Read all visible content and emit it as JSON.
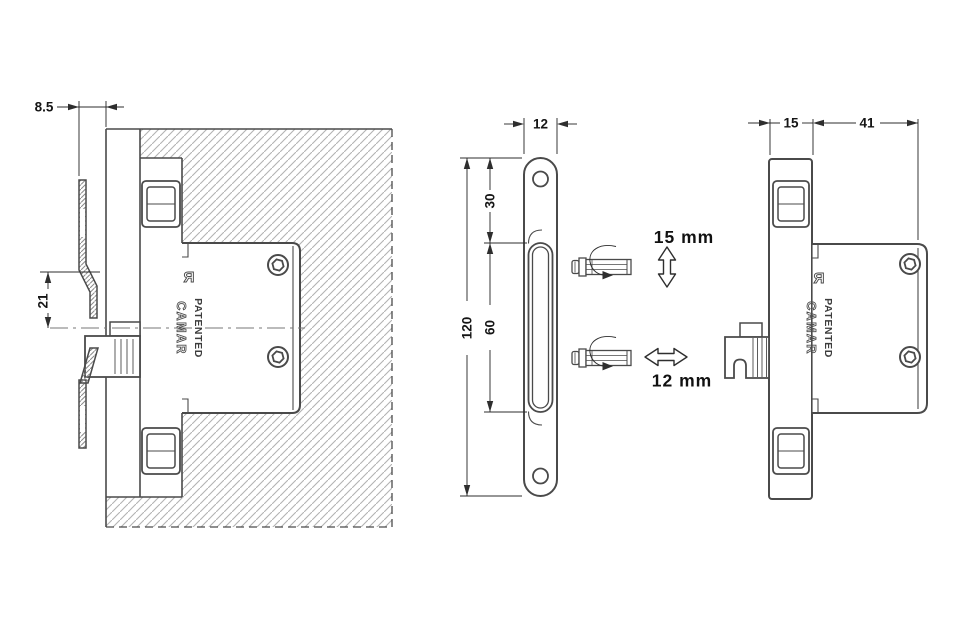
{
  "brand": {
    "name": "CAMAR",
    "patented": "PATENTED",
    "registered_mark": "R"
  },
  "views": {
    "section": {
      "dim_plate_offset": "8.5",
      "dim_hook_engagement": "21"
    },
    "front": {
      "dim_width": "12",
      "dim_hole_to_slot": "30",
      "dim_slot_length": "60",
      "dim_total_height": "120",
      "adjustment_vertical": "15 mm",
      "adjustment_horizontal": "12 mm"
    },
    "side": {
      "dim_plate_depth": "15",
      "dim_body_depth": "41"
    }
  },
  "colors": {
    "background": "#ffffff",
    "outline": "#4a4a4a",
    "dimension_lines": "#2e2e2e",
    "text": "#151515",
    "hatch": "#b3b3b3",
    "hatch_dense": "#8a8a8a"
  }
}
